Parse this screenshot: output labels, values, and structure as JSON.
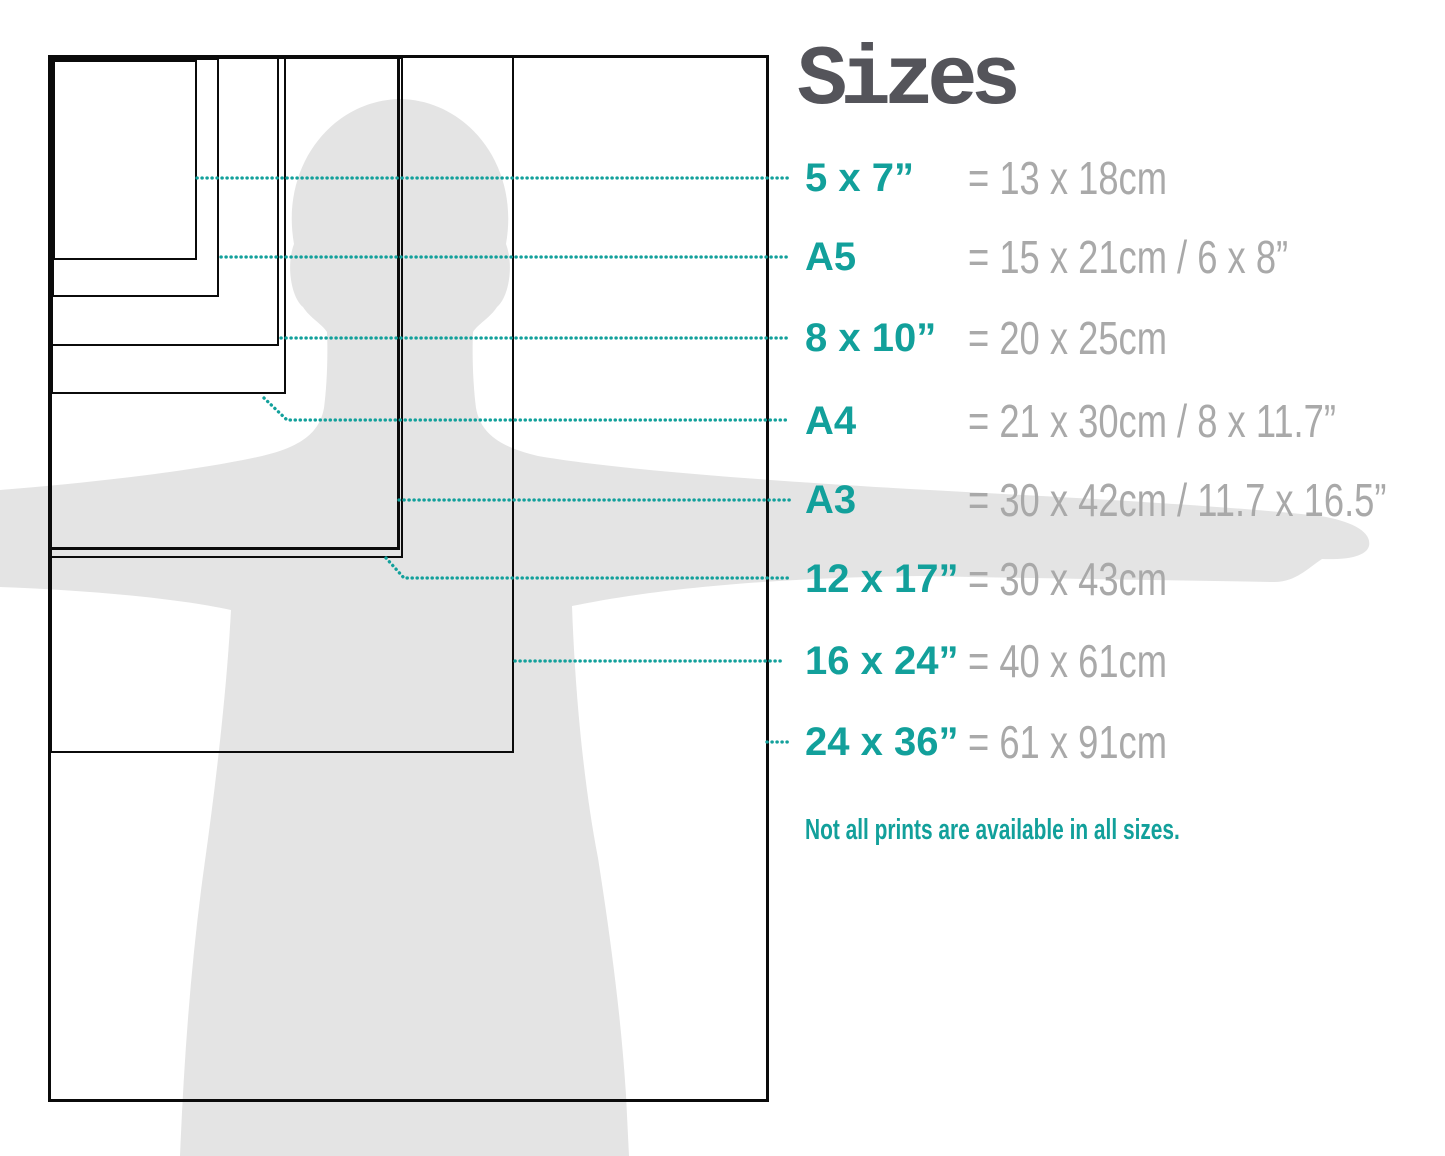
{
  "title": "Sizes",
  "note": "Not all prints are available in all sizes.",
  "colors": {
    "accent": "#12a09b",
    "metric_text": "#a9a9a9",
    "title_text": "#54545a",
    "silhouette": "#e4e4e4",
    "outline": "#0b0b0b"
  },
  "sizes": [
    {
      "id": "5x7",
      "label": "5 x 7”",
      "metric": "= 13 x 18cm"
    },
    {
      "id": "a5",
      "label": "A5",
      "metric": "= 15 x 21cm / 6 x 8”"
    },
    {
      "id": "8x10",
      "label": "8 x 10”",
      "metric": "= 20 x 25cm"
    },
    {
      "id": "a4",
      "label": "A4",
      "metric": "= 21 x 30cm / 8 x 11.7”"
    },
    {
      "id": "a3",
      "label": "A3",
      "metric": "= 30 x 42cm / 11.7 x 16.5”"
    },
    {
      "id": "12x17",
      "label": "12 x 17”",
      "metric": "= 30 x 43cm"
    },
    {
      "id": "16x24",
      "label": "16 x 24”",
      "metric": "= 40 x 61cm"
    },
    {
      "id": "24x36",
      "label": "24 x 36”",
      "metric": "= 61 x 91cm"
    }
  ],
  "diagram": {
    "row_y": [
      178,
      257,
      338,
      421,
      500,
      579,
      661,
      742
    ],
    "rects": [
      {
        "id": "24x36",
        "x": 48,
        "y": 55,
        "w": 721,
        "h": 1047,
        "b": 3
      },
      {
        "id": "16x24",
        "x": 50,
        "y": 56,
        "w": 464,
        "h": 697,
        "b": 2
      },
      {
        "id": "12x17",
        "x": 50,
        "y": 57,
        "w": 353,
        "h": 501,
        "b": 2
      },
      {
        "id": "a3",
        "x": 49,
        "y": 56,
        "w": 351,
        "h": 494,
        "b": 3
      },
      {
        "id": "a4",
        "x": 51,
        "y": 57,
        "w": 235,
        "h": 337,
        "b": 2
      },
      {
        "id": "8x10",
        "x": 51,
        "y": 57,
        "w": 228,
        "h": 289,
        "b": 2
      },
      {
        "id": "a5",
        "x": 52,
        "y": 58,
        "w": 167,
        "h": 239,
        "b": 2
      },
      {
        "id": "5x7",
        "x": 53,
        "y": 60,
        "w": 144,
        "h": 200,
        "b": 2
      }
    ],
    "callouts": [
      {
        "id": "5x7",
        "points": [
          [
            197,
            178
          ],
          [
            790,
            178
          ]
        ]
      },
      {
        "id": "a5",
        "points": [
          [
            221,
            257
          ],
          [
            790,
            257
          ]
        ]
      },
      {
        "id": "8x10",
        "points": [
          [
            281,
            338
          ],
          [
            790,
            338
          ]
        ]
      },
      {
        "id": "a4",
        "points": [
          [
            264,
            398
          ],
          [
            287,
            420
          ],
          [
            790,
            420
          ]
        ]
      },
      {
        "id": "a3",
        "points": [
          [
            399,
            500
          ],
          [
            790,
            500
          ]
        ]
      },
      {
        "id": "12x17",
        "points": [
          [
            386,
            558
          ],
          [
            404,
            578
          ],
          [
            790,
            578
          ]
        ]
      },
      {
        "id": "16x24",
        "points": [
          [
            515,
            661
          ],
          [
            782,
            661
          ]
        ]
      },
      {
        "id": "24x36",
        "points": [
          [
            767,
            742
          ],
          [
            789,
            742
          ]
        ]
      }
    ],
    "silhouette_path": "M 0,490 C 100,482 200,470 262,456 C 305,446 320,430 324,408 C 327,385 328,355 327,332 C 322,324 310,318 303,307 C 291,297 286,265 294,244 C 280,165 333,100 400,99 C 467,100 520,165 506,244 C 514,265 509,297 497,307 C 490,318 478,324 473,332 C 472,355 473,385 476,408 C 480,430 495,446 538,456 C 620,470 760,480 910,489 C 1060,497 1220,505 1320,516 C 1352,521 1372,532 1369,546 C 1366,557 1345,560 1322,559 C 1308,568 1295,583 1272,582 C 1150,580 1020,578 920,576 C 760,578 650,590 572,606 C 575,690 583,780 598,858 C 610,935 621,1015 626,1095 L 629,1156 L 180,1156 C 184,1058 191,962 204,868 C 217,776 227,686 231,610 C 175,598 85,590 0,587 Z"
  }
}
